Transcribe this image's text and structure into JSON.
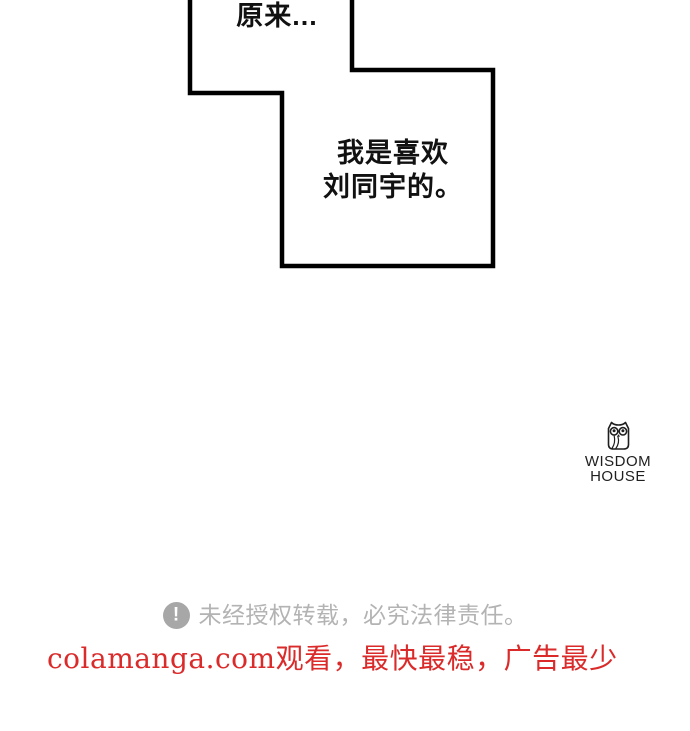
{
  "page": {
    "background_color": "#ffffff",
    "type": "comic-page"
  },
  "panel": {
    "border_color": "#000000",
    "bubble_fill": "#ffffff",
    "bubble1": {
      "text": "原来..."
    },
    "bubble2": {
      "line1": "我是喜欢",
      "line2": "刘同宇的。"
    }
  },
  "publisher": {
    "icon": "owl-icon",
    "name_line1": "WISDOM",
    "name_line2": "HOUSE",
    "color": "#1f1f1f"
  },
  "notice": {
    "icon": "exclamation-circle-icon",
    "icon_color": "#a7a7a7",
    "text": "未经授权转载，必究法律责任。",
    "text_color": "#b3b3b3"
  },
  "watermark": {
    "text": "colamanga.com观看，最快最稳，广告最少",
    "color": "#da2a2a"
  }
}
